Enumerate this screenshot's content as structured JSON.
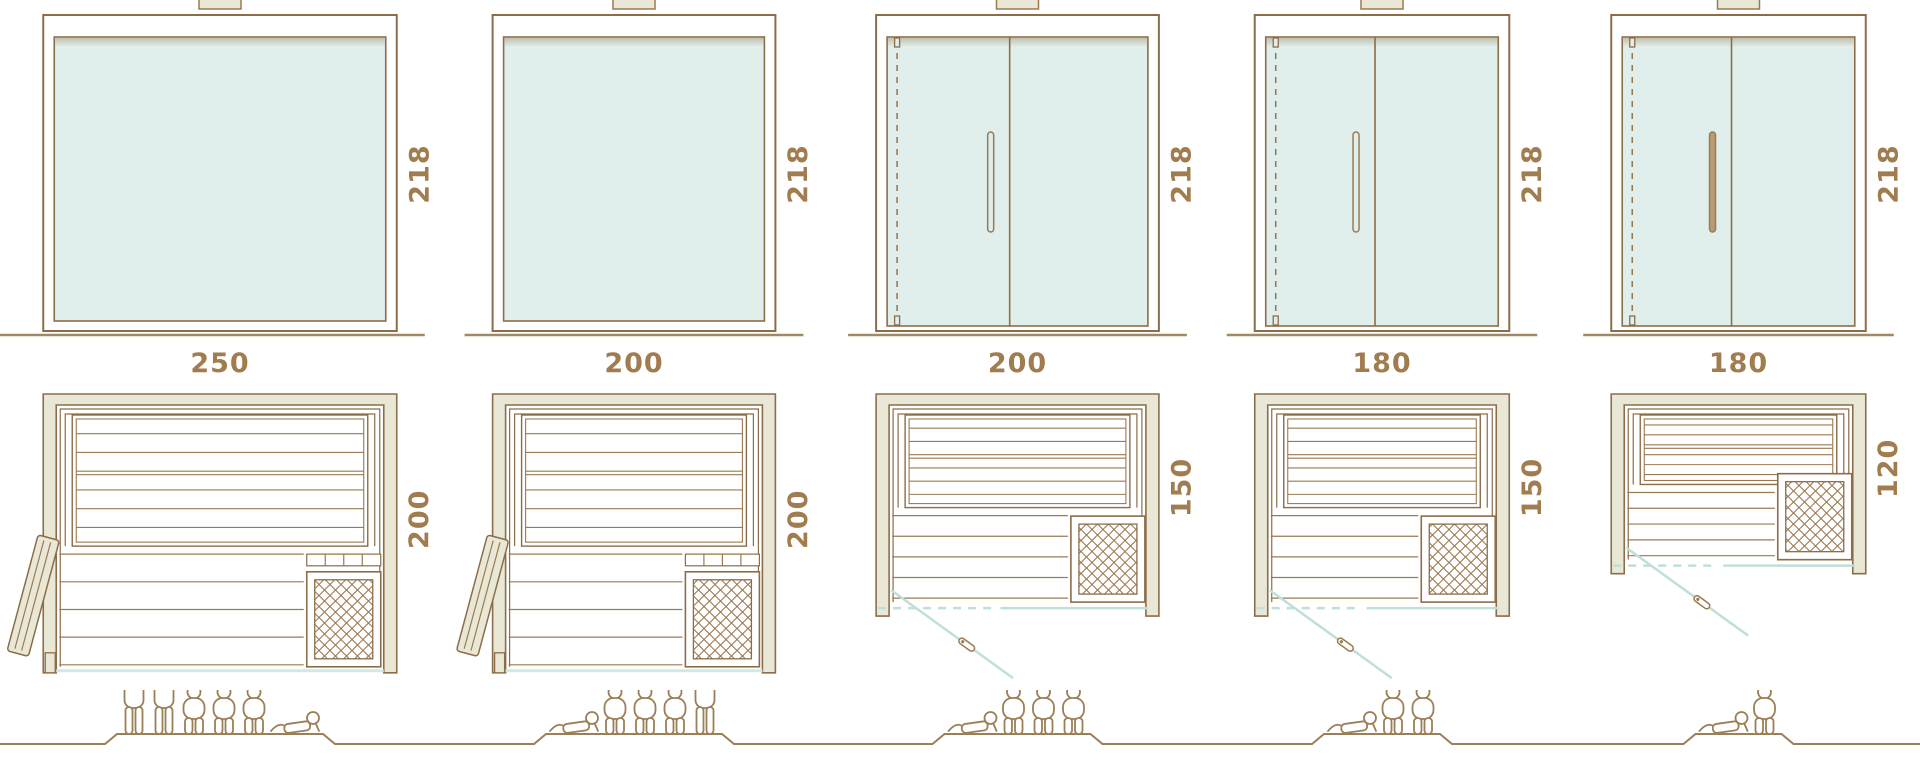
{
  "page": {
    "title": "Sauna size comparison diagram"
  },
  "colors": {
    "line": "#8c6d49",
    "line_light": "#9a7a52",
    "people_line": "#9b7f57",
    "wall_fill": "#e9e8d6",
    "glass_fill": "#e1efec",
    "teal_line": "#bfe0da",
    "teal_soft": "#cfe9e4",
    "dim_text": "#a07c4e",
    "ground_line": "#a18a63",
    "background": "#ffffff"
  },
  "models": [
    {
      "name": "sauna-250x200",
      "width_label": "250",
      "height_label": "218",
      "depth_label": "200",
      "width_cm": 250,
      "height_cm": 218,
      "depth_cm": 200,
      "elevation_type": "fixed-glass-front",
      "plan_door": "side-hinged-wood-door",
      "handle_style": "none",
      "capacity": {
        "standing": 2,
        "sitting": 3,
        "lying": 1,
        "total": 6
      },
      "capacity_order": [
        "standing",
        "standing",
        "sitting",
        "sitting",
        "sitting",
        "lying"
      ]
    },
    {
      "name": "sauna-200x200",
      "width_label": "200",
      "height_label": "218",
      "depth_label": "200",
      "width_cm": 200,
      "height_cm": 218,
      "depth_cm": 200,
      "elevation_type": "fixed-glass-front",
      "plan_door": "side-hinged-wood-door",
      "handle_style": "none",
      "capacity": {
        "standing": 1,
        "sitting": 3,
        "lying": 1,
        "total": 5
      },
      "capacity_order": [
        "lying",
        "sitting",
        "sitting",
        "sitting",
        "standing"
      ]
    },
    {
      "name": "sauna-200x150",
      "width_label": "200",
      "height_label": "218",
      "depth_label": "150",
      "width_cm": 200,
      "height_cm": 218,
      "depth_cm": 150,
      "elevation_type": "glass-front-with-door",
      "plan_door": "front-glass-swing-door",
      "handle_style": "outline",
      "capacity": {
        "standing": 0,
        "sitting": 3,
        "lying": 1,
        "total": 4
      },
      "capacity_order": [
        "lying",
        "sitting",
        "sitting",
        "sitting"
      ]
    },
    {
      "name": "sauna-180x150",
      "width_label": "180",
      "height_label": "218",
      "depth_label": "150",
      "width_cm": 180,
      "height_cm": 218,
      "depth_cm": 150,
      "elevation_type": "glass-front-with-door",
      "plan_door": "front-glass-swing-door",
      "handle_style": "outline",
      "capacity": {
        "standing": 0,
        "sitting": 2,
        "lying": 1,
        "total": 3
      },
      "capacity_order": [
        "lying",
        "sitting",
        "sitting"
      ]
    },
    {
      "name": "sauna-180x120",
      "width_label": "180",
      "height_label": "218",
      "depth_label": "120",
      "width_cm": 180,
      "height_cm": 218,
      "depth_cm": 120,
      "elevation_type": "glass-front-with-door",
      "plan_door": "front-glass-swing-door",
      "handle_style": "filled",
      "capacity": {
        "standing": 0,
        "sitting": 1,
        "lying": 1,
        "total": 2
      },
      "capacity_order": [
        "lying",
        "sitting"
      ]
    }
  ]
}
